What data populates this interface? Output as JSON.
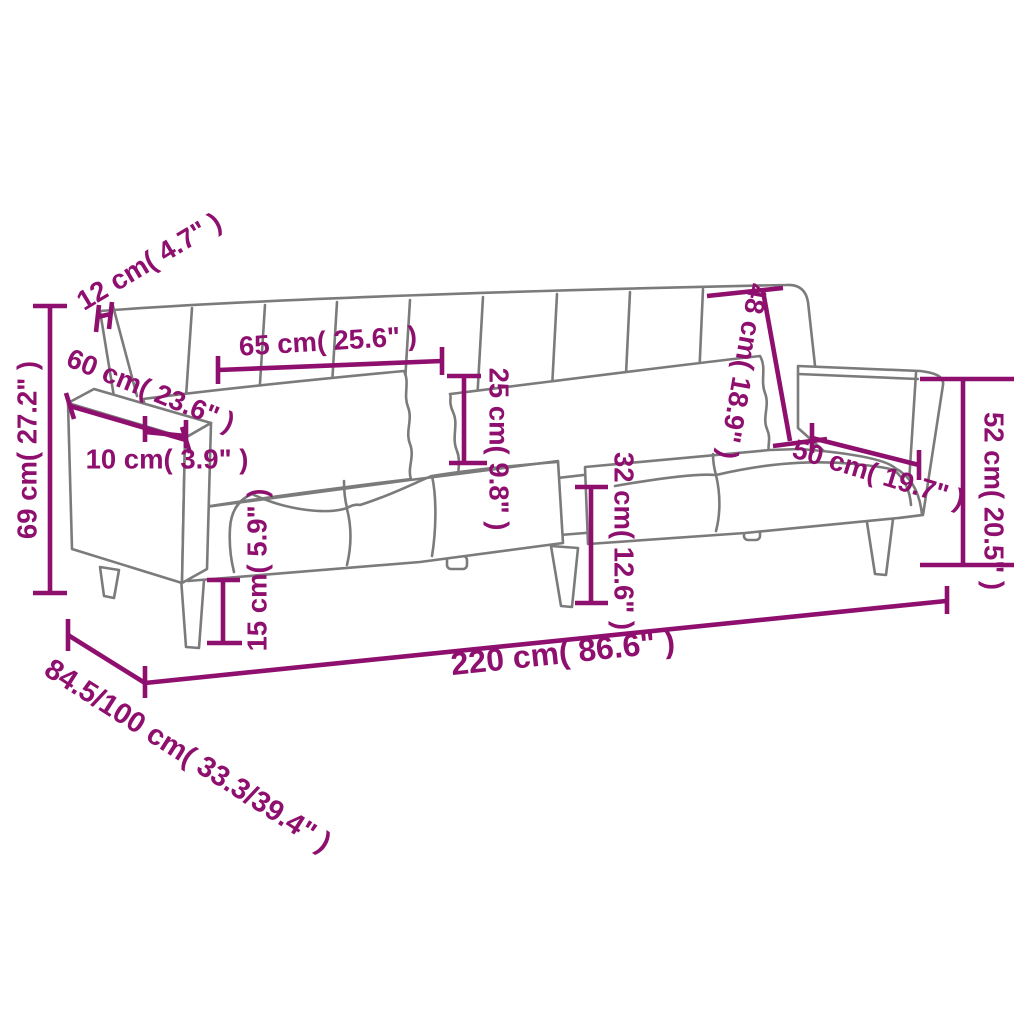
{
  "page": {
    "background": "#ffffff"
  },
  "diagram": {
    "type": "furniture-dimension-diagram",
    "subject": "sofa-bed-line-drawing",
    "accent_color": "#8E0F6E",
    "outline_color": "#7b7b7b",
    "dimensions": [
      {
        "id": "backrest-thickness",
        "label": "12 cm( 4.7\" )",
        "cm": "12",
        "inches": "4.7"
      },
      {
        "id": "armrest-depth",
        "label": "60 cm( 23.6\" )",
        "cm": "60",
        "inches": "23.6"
      },
      {
        "id": "overall-height",
        "label": "69 cm( 27.2\" )",
        "cm": "69",
        "inches": "27.2"
      },
      {
        "id": "armrest-width",
        "label": "10 cm( 3.9\" )",
        "cm": "10",
        "inches": "3.9"
      },
      {
        "id": "pillow-length",
        "label": "65 cm( 25.6\" )",
        "cm": "65",
        "inches": "25.6"
      },
      {
        "id": "pillow-height",
        "label": "25 cm( 9.8\" )",
        "cm": "25",
        "inches": "9.8"
      },
      {
        "id": "backrest-height",
        "label": "48 cm( 18.9\" )",
        "cm": "48",
        "inches": "18.9"
      },
      {
        "id": "seat-depth",
        "label": "50 cm( 19.7\" )",
        "cm": "50",
        "inches": "19.7"
      },
      {
        "id": "armrest-height",
        "label": "52 cm( 20.5\" )",
        "cm": "52",
        "inches": "20.5"
      },
      {
        "id": "seat-height",
        "label": "32 cm( 12.6\" )",
        "cm": "32",
        "inches": "12.6"
      },
      {
        "id": "leg-height",
        "label": "15 cm( 5.9\" )",
        "cm": "15",
        "inches": "5.9"
      },
      {
        "id": "overall-width",
        "label": "220 cm( 86.6\" )",
        "cm": "220",
        "inches": "86.6"
      },
      {
        "id": "overall-depth",
        "label": "84.5/100 cm( 33.3/39.4\" )",
        "cm": "84.5/100",
        "inches": "33.3/39.4"
      }
    ]
  }
}
